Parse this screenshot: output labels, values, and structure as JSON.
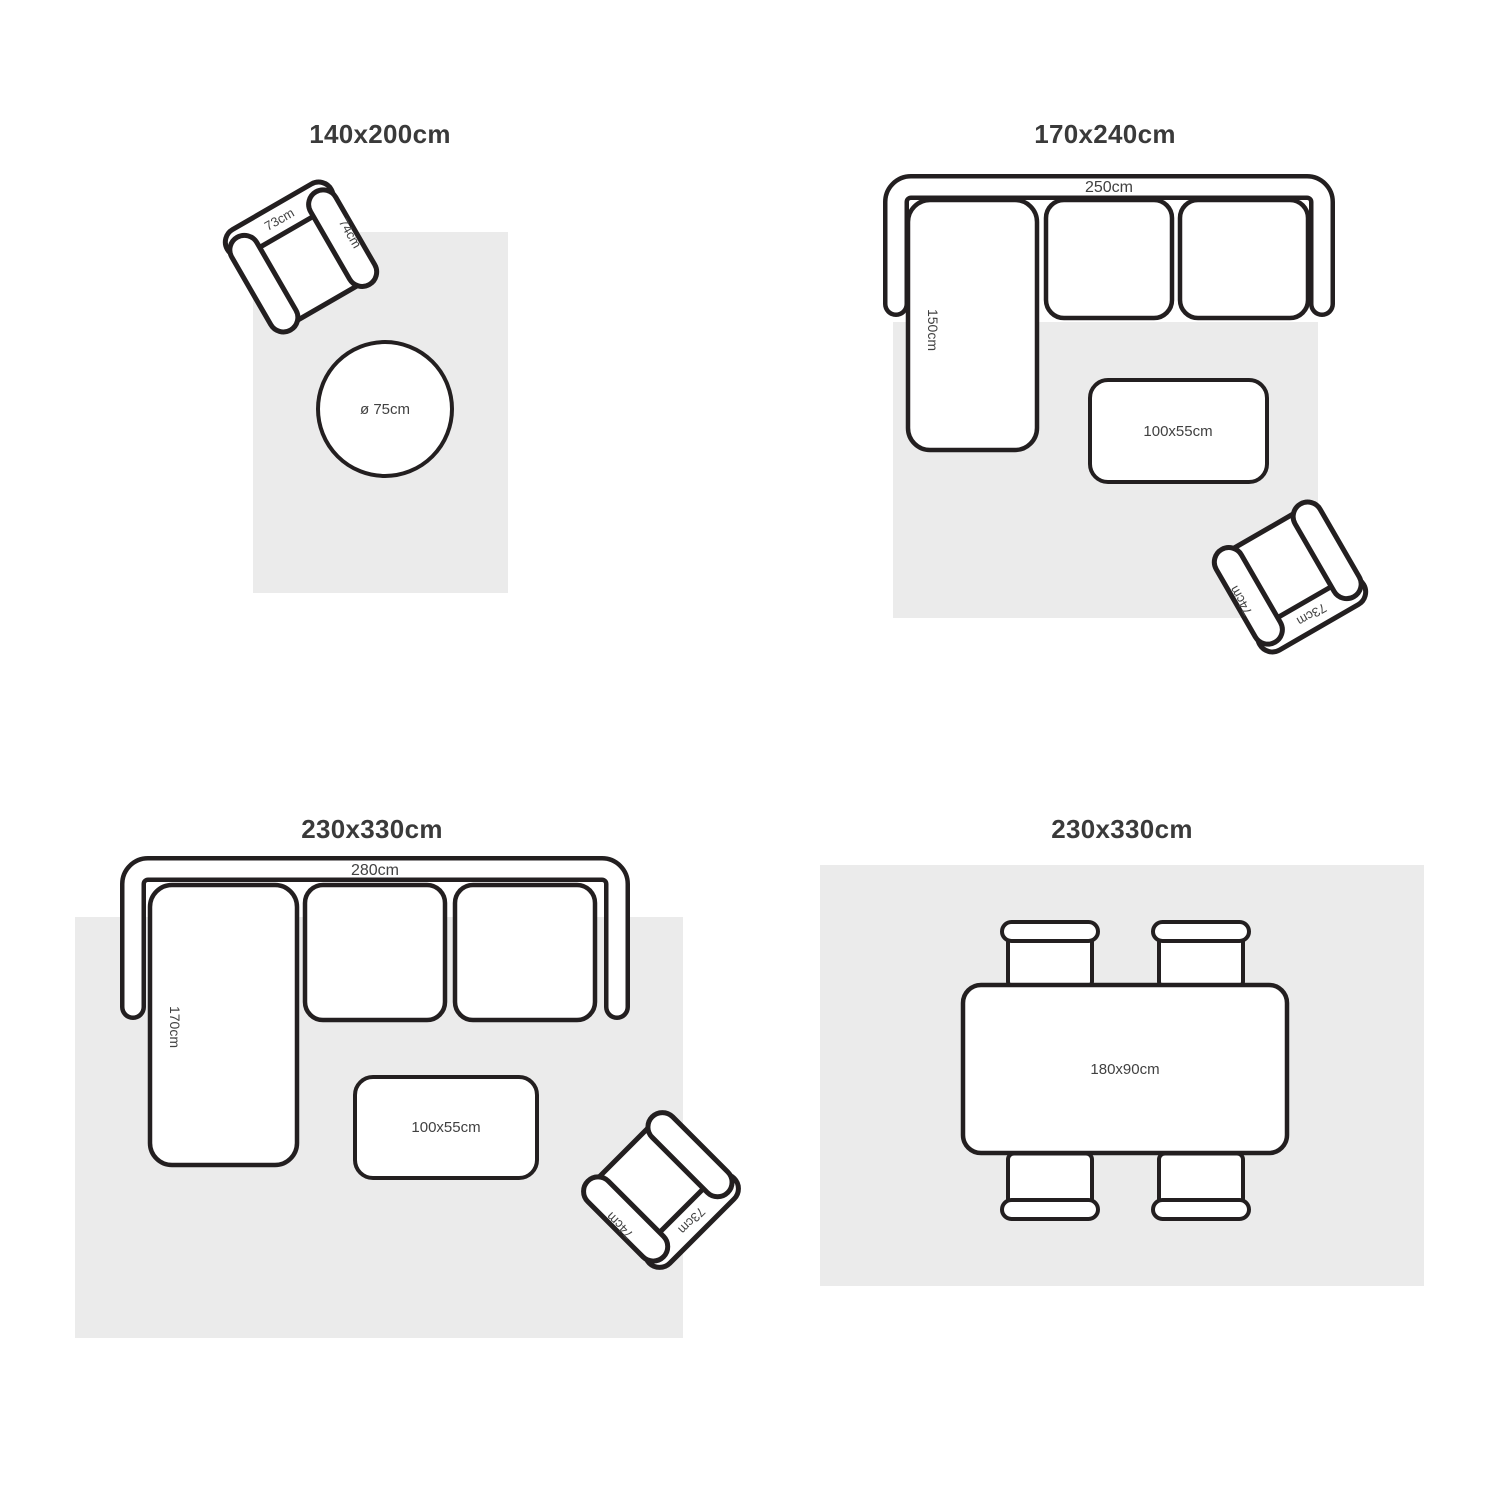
{
  "colors": {
    "background": "#ffffff",
    "rug": "#ebebeb",
    "stroke": "#231f20",
    "title_text": "#3a3a3a",
    "label_text": "#414141"
  },
  "armchair": {
    "back_label": "73cm",
    "side_label": "74cm"
  },
  "panels": {
    "top_left": {
      "title": "140x200cm",
      "round_table_label": "ø 75cm"
    },
    "top_right": {
      "title": "170x240cm",
      "sofa_width_label": "250cm",
      "chaise_label": "150cm",
      "coffee_table_label": "100x55cm"
    },
    "bottom_left": {
      "title": "230x330cm",
      "sofa_width_label": "280cm",
      "chaise_label": "170cm",
      "coffee_table_label": "100x55cm"
    },
    "bottom_right": {
      "title": "230x330cm",
      "dining_table_label": "180x90cm"
    }
  }
}
